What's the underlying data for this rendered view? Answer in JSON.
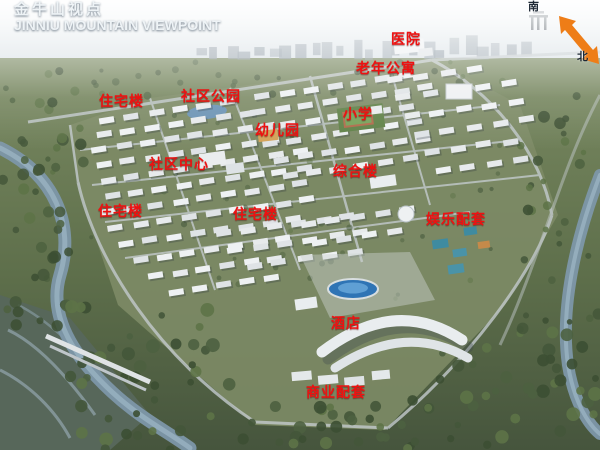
{
  "title": {
    "cn": "金牛山视点",
    "en": "JINNIU MOUNTAIN VIEWPOINT"
  },
  "compass": {
    "south_label": "南",
    "north_label": "北"
  },
  "label_style": {
    "color": "#ee1111"
  },
  "arrow_color": "#ee7d17",
  "labels": [
    {
      "id": "hospital",
      "text": "医院",
      "x": 391,
      "y": 31
    },
    {
      "id": "senior-apartments",
      "text": "老年公寓",
      "x": 356,
      "y": 60
    },
    {
      "id": "residential-1",
      "text": "住宅楼",
      "x": 99,
      "y": 93
    },
    {
      "id": "community-park",
      "text": "社区公园",
      "x": 181,
      "y": 88
    },
    {
      "id": "primary-school",
      "text": "小学",
      "x": 343,
      "y": 106
    },
    {
      "id": "kindergarten",
      "text": "幼儿园",
      "x": 255,
      "y": 122
    },
    {
      "id": "community-center",
      "text": "社区中心",
      "x": 149,
      "y": 156
    },
    {
      "id": "mixed-use-building",
      "text": "综合楼",
      "x": 333,
      "y": 163
    },
    {
      "id": "residential-2",
      "text": "住宅楼",
      "x": 98,
      "y": 203
    },
    {
      "id": "residential-3",
      "text": "住宅楼",
      "x": 233,
      "y": 206
    },
    {
      "id": "entertainment-facilities",
      "text": "娱乐配套",
      "x": 426,
      "y": 211
    },
    {
      "id": "hotel",
      "text": "酒店",
      "x": 331,
      "y": 315
    },
    {
      "id": "commercial-facilities",
      "text": "商业配套",
      "x": 306,
      "y": 384
    }
  ]
}
